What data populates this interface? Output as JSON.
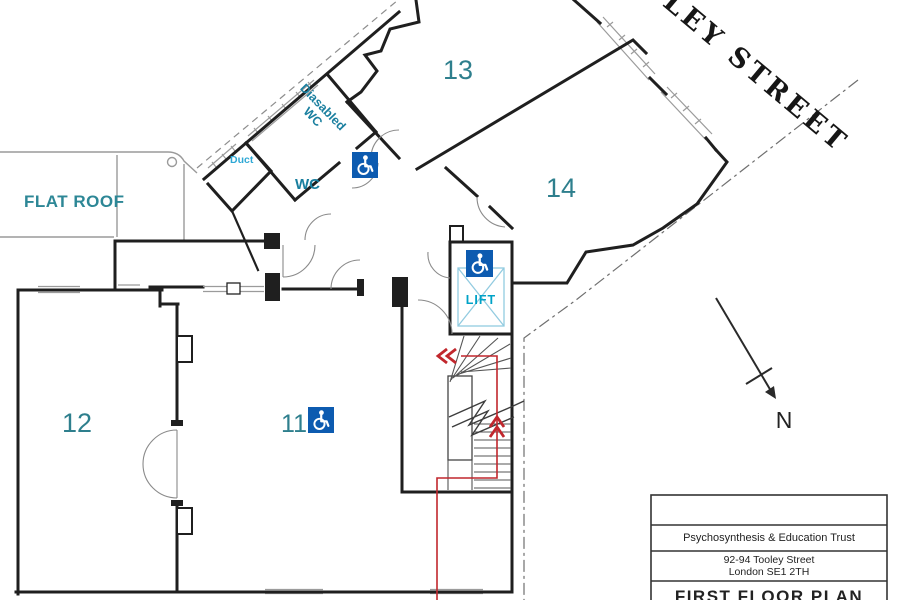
{
  "plan": {
    "street_label": "TOOLEY STREET",
    "flat_roof_label": "FLAT ROOF",
    "north_label": "N",
    "rooms": [
      {
        "id": "room-13",
        "number": "13"
      },
      {
        "id": "room-14",
        "number": "14"
      },
      {
        "id": "room-12",
        "number": "12"
      },
      {
        "id": "room-11",
        "number": "11"
      }
    ],
    "facilities": {
      "duct": "Duct",
      "disabled_wc_line1": "Diasabled",
      "disabled_wc_line2": "WC",
      "wc": "WC",
      "lift": "LIFT"
    },
    "icons": {
      "wheelchair": "wheelchair-access-icon"
    },
    "colors": {
      "room_number_teal": "#2e7f8d",
      "label_teal": "#1a7f9f",
      "label_cyan": "#2fa8d5",
      "lift_cyan": "#00a2c7",
      "icon_blue": "#0d5bb0",
      "escape_route_red": "#c1272d",
      "wall_black": "#1f1f1f"
    }
  },
  "title_block": {
    "organisation": "Psychosynthesis & Education Trust",
    "address_line1": "92-94 Tooley Street",
    "address_line2": "London SE1 2TH",
    "drawing_title": "FIRST FLOOR PLAN"
  },
  "watermark": {
    "text": "venue"
  }
}
